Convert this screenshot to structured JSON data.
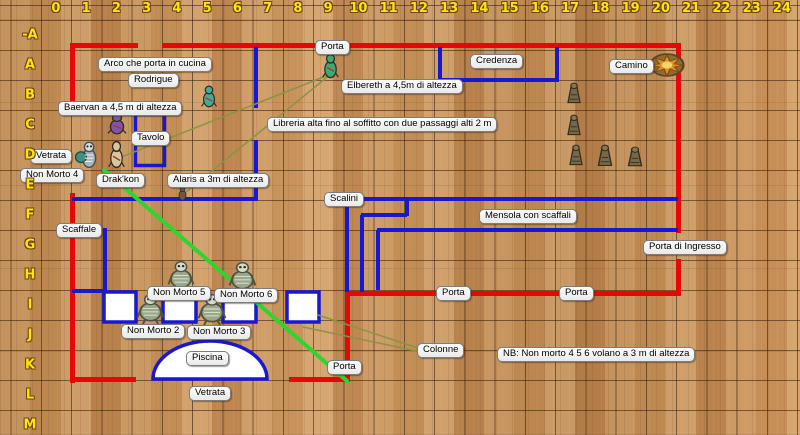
{
  "map": {
    "colors": {
      "wall": "#e60808",
      "feature": "#1818cf",
      "movement": "#2fd42f",
      "sight": "#8a9440",
      "floor_base": "#c28850",
      "grid_label": "#ffe40a",
      "pillar_fill": "#ffffff"
    },
    "grid": {
      "cols": [
        "0",
        "1",
        "2",
        "3",
        "4",
        "5",
        "6",
        "7",
        "8",
        "9",
        "10",
        "11",
        "12",
        "13",
        "14",
        "15",
        "16",
        "17",
        "18",
        "19",
        "20",
        "21",
        "22",
        "23",
        "24"
      ],
      "rows": [
        "-A",
        "A",
        "B",
        "C",
        "D",
        "E",
        "F",
        "G",
        "H",
        "I",
        "J",
        "K",
        "L",
        "M"
      ],
      "cell_w": 30.25,
      "cell_h": 30,
      "x0": 10.5,
      "y0": 20
    },
    "walls": [
      [
        70,
        43,
        68,
        5
      ],
      [
        162,
        43,
        519,
        5
      ],
      [
        70,
        43,
        5,
        58
      ],
      [
        70,
        193,
        5,
        190
      ],
      [
        676,
        43,
        5,
        190
      ],
      [
        676,
        259,
        5,
        37
      ],
      [
        345,
        291,
        336,
        5
      ],
      [
        345,
        291,
        5,
        91
      ],
      [
        70,
        377,
        66,
        5
      ],
      [
        289,
        377,
        61,
        5
      ]
    ],
    "features": [
      [
        254,
        47,
        4,
        61
      ],
      [
        254,
        140,
        4,
        59
      ],
      [
        72,
        197,
        186,
        4
      ],
      [
        103,
        228,
        4,
        64
      ],
      [
        72,
        289,
        33,
        4
      ],
      [
        438,
        47,
        4,
        34
      ],
      [
        555,
        47,
        4,
        34
      ],
      [
        438,
        78,
        121,
        4
      ],
      [
        363,
        197,
        315,
        4
      ],
      [
        405,
        199,
        4,
        17
      ],
      [
        361,
        213,
        46,
        4
      ],
      [
        360,
        215,
        4,
        77
      ],
      [
        377,
        228,
        301,
        4
      ],
      [
        376,
        230,
        4,
        60
      ],
      [
        345,
        199,
        4,
        93
      ]
    ],
    "tavolo_rect": [
      134,
      113,
      32,
      54
    ],
    "pillars": [
      [
        104,
        292,
        32,
        30
      ],
      [
        163,
        292,
        33,
        30
      ],
      [
        223,
        292,
        33,
        30
      ],
      [
        287,
        292,
        32,
        30
      ]
    ],
    "pool": {
      "cx": 210,
      "base_y": 379,
      "rx": 57,
      "ry": 38
    },
    "lines": [
      {
        "x1": 104,
        "y1": 170,
        "x2": 347,
        "y2": 381,
        "c": "movement",
        "w": 4
      },
      {
        "x1": 331,
        "y1": 74,
        "x2": 114,
        "y2": 160,
        "c": "sight",
        "w": 1.5
      },
      {
        "x1": 331,
        "y1": 74,
        "x2": 186,
        "y2": 192,
        "c": "sight",
        "w": 1.5
      },
      {
        "x1": 318,
        "y1": 315,
        "x2": 421,
        "y2": 349,
        "c": "sight",
        "w": 1.5
      },
      {
        "x1": 303,
        "y1": 327,
        "x2": 421,
        "y2": 352,
        "c": "sight",
        "w": 1.5
      }
    ],
    "tokens": [
      {
        "name": "token-rodrigue",
        "kind": "figure",
        "color": "#49a893",
        "x": 199,
        "y": 84,
        "w": 20,
        "h": 24
      },
      {
        "name": "token-elbereth",
        "kind": "figure",
        "color": "#3fa873",
        "x": 320,
        "y": 52,
        "w": 21,
        "h": 27
      },
      {
        "name": "token-baervan",
        "kind": "figure",
        "color": "#8055a8",
        "x": 105,
        "y": 112,
        "w": 24,
        "h": 23
      },
      {
        "name": "token-non-morto-4",
        "kind": "skeleton",
        "color": "#aab2ba",
        "x": 75,
        "y": 140,
        "w": 26,
        "h": 30
      },
      {
        "name": "token-drakkon",
        "kind": "figure",
        "color": "#d9c79c",
        "x": 106,
        "y": 139,
        "w": 21,
        "h": 30
      },
      {
        "name": "token-alaris",
        "kind": "figure",
        "color": "#6a5a40",
        "x": 176,
        "y": 185,
        "w": 13,
        "h": 16
      },
      {
        "name": "token-non-morto-5",
        "kind": "beast",
        "x": 166,
        "y": 260,
        "w": 30,
        "h": 31
      },
      {
        "name": "token-non-morto-6",
        "kind": "beast",
        "x": 227,
        "y": 261,
        "w": 31,
        "h": 31
      },
      {
        "name": "token-non-morto-2",
        "kind": "beast",
        "x": 135,
        "y": 293,
        "w": 31,
        "h": 31
      },
      {
        "name": "token-non-morto-3",
        "kind": "beast",
        "x": 196,
        "y": 293,
        "w": 32,
        "h": 32
      },
      {
        "name": "token-statua-1",
        "kind": "statue",
        "x": 562,
        "y": 82,
        "w": 24,
        "h": 24
      },
      {
        "name": "token-statua-2",
        "kind": "statue",
        "x": 562,
        "y": 114,
        "w": 24,
        "h": 24
      },
      {
        "name": "token-statua-3",
        "kind": "statue",
        "x": 564,
        "y": 144,
        "w": 24,
        "h": 24
      },
      {
        "name": "token-statua-4",
        "kind": "statue",
        "x": 592,
        "y": 144,
        "w": 26,
        "h": 25
      },
      {
        "name": "token-statua-5",
        "kind": "statue",
        "x": 622,
        "y": 146,
        "w": 26,
        "h": 23
      },
      {
        "name": "token-camino",
        "kind": "fire",
        "x": 649,
        "y": 51,
        "w": 36,
        "h": 28
      }
    ],
    "labels": [
      {
        "name": "label-porta-nord",
        "text": "Porta",
        "x": 315,
        "y": 40
      },
      {
        "name": "label-arco-cucina",
        "text": "Arco che porta in cucina",
        "x": 98,
        "y": 57
      },
      {
        "name": "label-rodrigue",
        "text": "Rodrigue",
        "x": 128,
        "y": 73
      },
      {
        "name": "label-baervan",
        "text": "Baervan a 4,5 m di altezza",
        "x": 58,
        "y": 101
      },
      {
        "name": "label-credenza",
        "text": "Credenza",
        "x": 470,
        "y": 54
      },
      {
        "name": "label-camino",
        "text": "Camino",
        "x": 609,
        "y": 59
      },
      {
        "name": "label-elbereth",
        "text": "Elbereth a 4,5m di altezza",
        "x": 341,
        "y": 79
      },
      {
        "name": "label-libreria",
        "text": "Libreria alta fino al soffitto con due passaggi alti 2 m",
        "x": 267,
        "y": 117
      },
      {
        "name": "label-vetrata-ovest",
        "text": "Vetrata",
        "x": 30,
        "y": 149
      },
      {
        "name": "label-non-morto-4",
        "text": "Non Morto 4",
        "x": 20,
        "y": 168
      },
      {
        "name": "label-tavolo",
        "text": "Tavolo",
        "x": 131,
        "y": 131
      },
      {
        "name": "label-drakkon",
        "text": "Drak'kon",
        "x": 96,
        "y": 173
      },
      {
        "name": "label-alaris",
        "text": "Alaris a 3m di altezza",
        "x": 167,
        "y": 173
      },
      {
        "name": "label-scalini",
        "text": "Scalini",
        "x": 324,
        "y": 192
      },
      {
        "name": "label-mensola",
        "text": "Mensola con scaffali",
        "x": 479,
        "y": 209
      },
      {
        "name": "label-porta-ingresso",
        "text": "Porta di Ingresso",
        "x": 643,
        "y": 240
      },
      {
        "name": "label-scaffale",
        "text": "Scaffale",
        "x": 56,
        "y": 223
      },
      {
        "name": "label-porta-sud-1",
        "text": "Porta",
        "x": 436,
        "y": 286
      },
      {
        "name": "label-porta-sud-2",
        "text": "Porta",
        "x": 559,
        "y": 286
      },
      {
        "name": "label-non-morto-5",
        "text": "Non Morto 5",
        "x": 147,
        "y": 286
      },
      {
        "name": "label-non-morto-6",
        "text": "Non Morto 6",
        "x": 214,
        "y": 288
      },
      {
        "name": "label-non-morto-2",
        "text": "Non Morto 2",
        "x": 121,
        "y": 324
      },
      {
        "name": "label-non-morto-3",
        "text": "Non Morto 3",
        "x": 187,
        "y": 325
      },
      {
        "name": "label-piscina",
        "text": "Piscina",
        "x": 186,
        "y": 351
      },
      {
        "name": "label-vetrata-sud",
        "text": "Vetrata",
        "x": 189,
        "y": 386
      },
      {
        "name": "label-porta-piscina",
        "text": "Porta",
        "x": 327,
        "y": 360
      },
      {
        "name": "label-colonne",
        "text": "Colonne",
        "x": 417,
        "y": 343
      },
      {
        "name": "label-nb-volano",
        "text": "NB: Non morto 4 5 6 volano a 3 m di altezza",
        "x": 497,
        "y": 347
      }
    ]
  }
}
